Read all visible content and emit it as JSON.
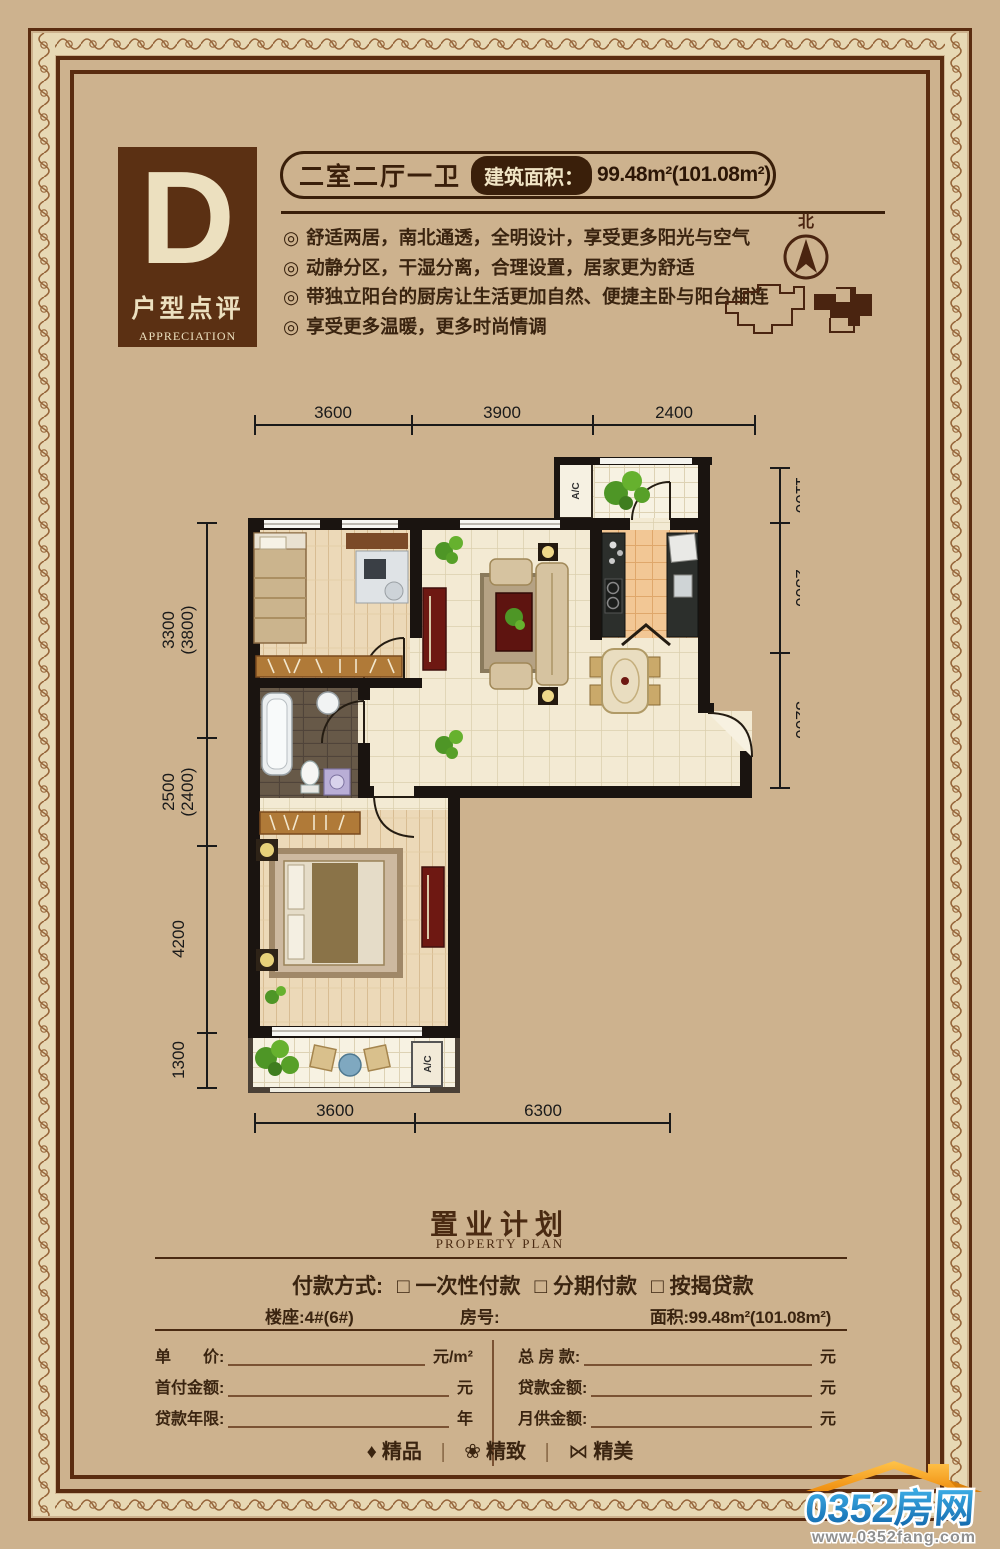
{
  "unit": {
    "letter": "D",
    "label": "户型点评",
    "label_en": "APPRECIATION",
    "layout": "二室二厅一卫",
    "area_label": "建筑面积：",
    "area_value": "99.48m²(101.08m²)"
  },
  "features": {
    "marker": "◎",
    "items": [
      "舒适两居，南北通透，全明设计，享受更多阳光与空气",
      "动静分区，干湿分离，合理设置，居家更为舒适",
      "带独立阳台的厨房让生活更加自然、便捷主卧与阳台相连",
      "享受更多温暖，更多时尚情调"
    ]
  },
  "compass": {
    "north": "北"
  },
  "floorplan": {
    "ac_label": "A/C",
    "dims_top": [
      "3600",
      "3900",
      "2400"
    ],
    "dims_left": [
      {
        "main": "3300",
        "alt": "(3800)"
      },
      {
        "main": "2500",
        "alt": "(2400)"
      },
      {
        "main": "4200",
        "alt": ""
      },
      {
        "main": "1300",
        "alt": ""
      }
    ],
    "dims_right": [
      "1100",
      "2300",
      "3200"
    ],
    "dims_bottom": [
      "3600",
      "6300"
    ]
  },
  "plan_section": {
    "title": "置业计划",
    "subtitle": "PROPERTY PLAN",
    "payment_label": "付款方式:",
    "payment_options": [
      "□ 一次性付款",
      "□ 分期付款",
      "□ 按揭贷款"
    ],
    "info": {
      "building": "楼座:4#(6#)",
      "room": "房号:",
      "area": "面积:99.48m²(101.08m²)"
    },
    "fields_left": [
      {
        "label": "单　　价:",
        "unit": "元/m²"
      },
      {
        "label": "首付金额:",
        "unit": "元"
      },
      {
        "label": "贷款年限:",
        "unit": "年"
      }
    ],
    "fields_right": [
      {
        "label": "总 房 款:",
        "unit": "元"
      },
      {
        "label": "贷款金额:",
        "unit": "元"
      },
      {
        "label": "月供金额:",
        "unit": "元"
      }
    ],
    "badges": {
      "divider": "|",
      "items": [
        {
          "icon": "♦",
          "text": "精品"
        },
        {
          "icon": "❀",
          "text": "精致"
        },
        {
          "icon": "⋈",
          "text": "精美"
        }
      ]
    }
  },
  "logo": {
    "name": "0352房网",
    "url_text": "www.0352fang.com"
  },
  "colors": {
    "background": "#cdb28e",
    "frame_brown": "#5a2c10",
    "dark_box": "#5b3013",
    "cream": "#ece0bf",
    "text_dark": "#3a2410",
    "wall_black": "#1a1410",
    "logo_blue": "#1d7fc6",
    "logo_orange": "#f49d1c"
  }
}
